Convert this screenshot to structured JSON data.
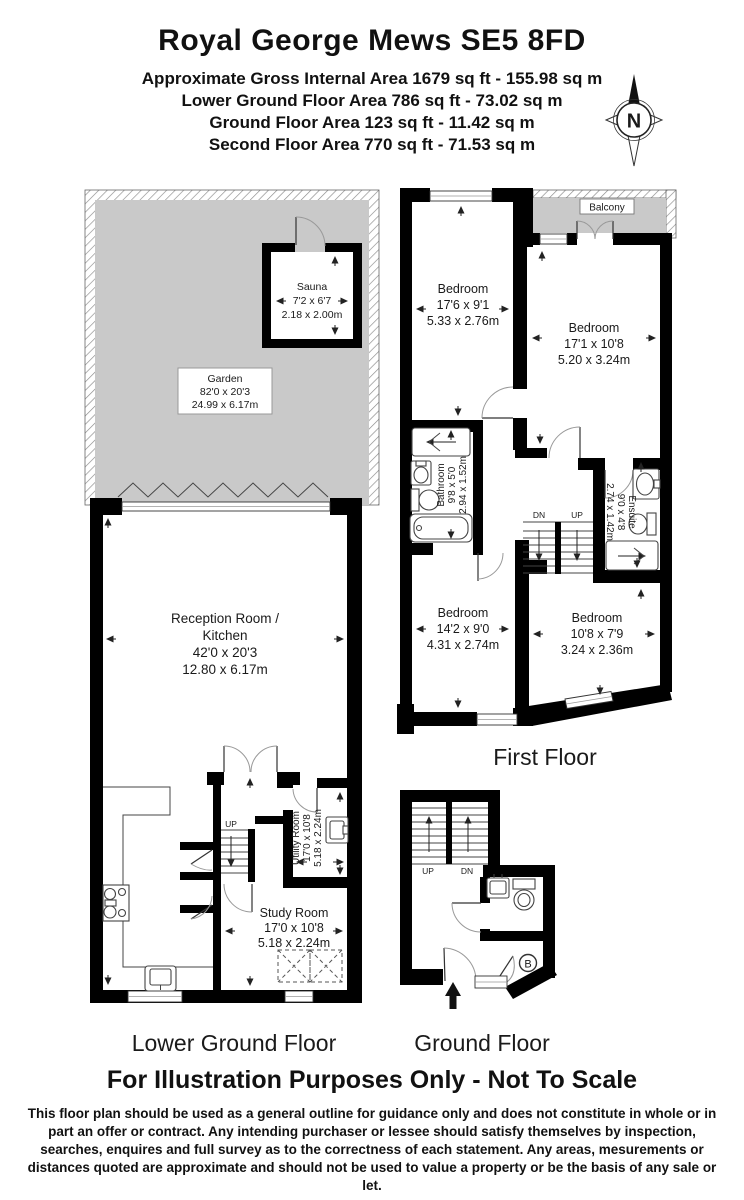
{
  "header": {
    "title": "Royal George Mews SE5 8FD",
    "area_lines": [
      "Approximate Gross Internal Area 1679 sq ft - 155.98 sq m",
      "Lower Ground Floor Area 786 sq ft - 73.02 sq m",
      "Ground Floor Area 123 sq ft - 11.42 sq m",
      "Second Floor Area 770 sq ft - 71.53 sq m"
    ]
  },
  "compass": {
    "label": "N"
  },
  "floors": {
    "lower_ground": {
      "label": "Lower Ground Floor",
      "stairs_up": "UP",
      "rooms": {
        "garden": {
          "name": "Garden",
          "imperial": "82'0 x 20'3",
          "metric": "24.99 x 6.17m"
        },
        "sauna": {
          "name": "Sauna",
          "imperial": "7'2 x 6'7",
          "metric": "2.18 x 2.00m"
        },
        "reception": {
          "line1": "Reception Room /",
          "line2": "Kitchen",
          "imperial": "42'0 x 20'3",
          "metric": "12.80 x 6.17m"
        },
        "utility": {
          "name": "Utility Room",
          "imperial": "17'0 x 10'8",
          "metric": "5.18 x 2.24m"
        },
        "study": {
          "name": "Study Room",
          "imperial": "17'0 x 10'8",
          "metric": "5.18 x 2.24m"
        }
      }
    },
    "first": {
      "label": "First Floor",
      "stairs_dn": "DN",
      "stairs_up": "UP",
      "rooms": {
        "balcony": {
          "name": "Balcony"
        },
        "bedroom_front": {
          "name": "Bedroom",
          "imperial": "17'6 x 9'1",
          "metric": "5.33 x 2.76m"
        },
        "bedroom_rear": {
          "name": "Bedroom",
          "imperial": "17'1 x 10'8",
          "metric": "5.20 x 3.24m"
        },
        "bathroom": {
          "name": "Bathroom",
          "imperial": "9'8 x 5'0",
          "metric": "2.94 x 1.52m"
        },
        "ensuite": {
          "name": "Ensuite",
          "imperial": "9'0 x 4'8",
          "metric": "2.74 x 1.42m"
        },
        "bedroom_mid": {
          "name": "Bedroom",
          "imperial": "14'2 x 9'0",
          "metric": "4.31 x 2.74m"
        },
        "bedroom_small": {
          "name": "Bedroom",
          "imperial": "10'8 x 7'9",
          "metric": "3.24 x 2.36m"
        }
      }
    },
    "ground": {
      "label": "Ground Floor",
      "stairs_up": "UP",
      "stairs_dn": "DN",
      "boiler": "B"
    }
  },
  "footer": {
    "title": "For Illustration Purposes Only - Not To Scale",
    "disclaimer": "This floor plan should be used as a general outline for guidance only and does not constitute in whole or in part an offer or contract. Any intending purchaser or lessee should satisfy themselves by inspection, searches, enquires and full survey as to the correctness of each statement. Any areas, mesurements or distances quoted are approximate and should not be used to value a property or be the basis of any sale or let."
  },
  "colors": {
    "wall": "#000000",
    "outdoor_fill": "#c9c9c9"
  }
}
